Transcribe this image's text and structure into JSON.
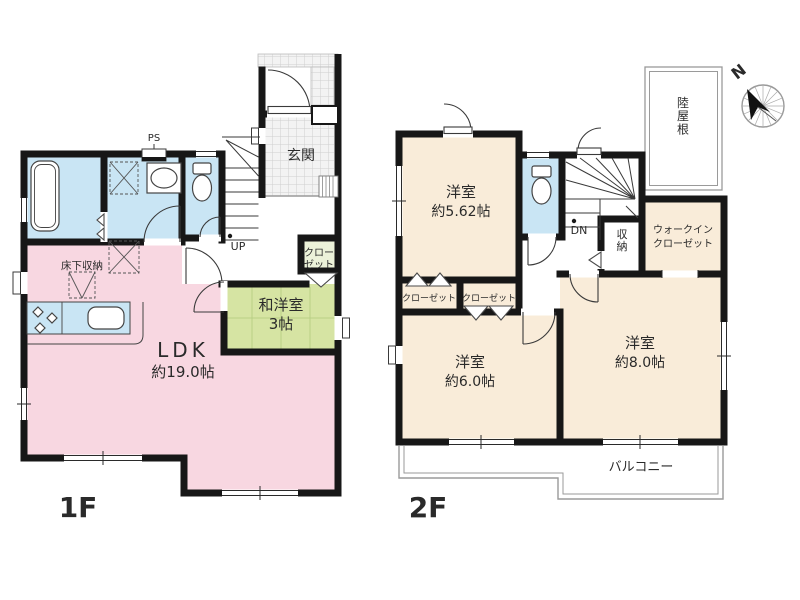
{
  "floor1": {
    "floor_label": "1F",
    "ldk_name": "LDK",
    "ldk_area": "約19.0帖",
    "wayo_name": "和洋室",
    "wayo_area": "3帖",
    "genkan": "玄関",
    "closet_l1": "クロー",
    "closet_l2": "ゼット",
    "underfloor": "床下収納",
    "ps": "PS",
    "up": "UP"
  },
  "floor2": {
    "floor_label": "2F",
    "room562_name": "洋室",
    "room562_area": "約5.62帖",
    "room60_name": "洋室",
    "room60_area": "約6.0帖",
    "room80_name": "洋室",
    "room80_area": "約8.0帖",
    "closet_a": "クローゼット",
    "closet_b": "クローゼット",
    "wic_l1": "ウォークイン",
    "wic_l2": "クローゼット",
    "storage": "収納",
    "dn": "DN",
    "flat_roof": "陸屋根",
    "balcony": "バルコニー"
  },
  "compass_n": "N",
  "colors": {
    "ldk_pink": "#f8d7e1",
    "tatami_green": "#d6e4a3",
    "closet_green": "#ecf2d9",
    "wet_blue": "#c9e5f4",
    "room_cream": "#f9ecd9",
    "wall": "#171717"
  }
}
